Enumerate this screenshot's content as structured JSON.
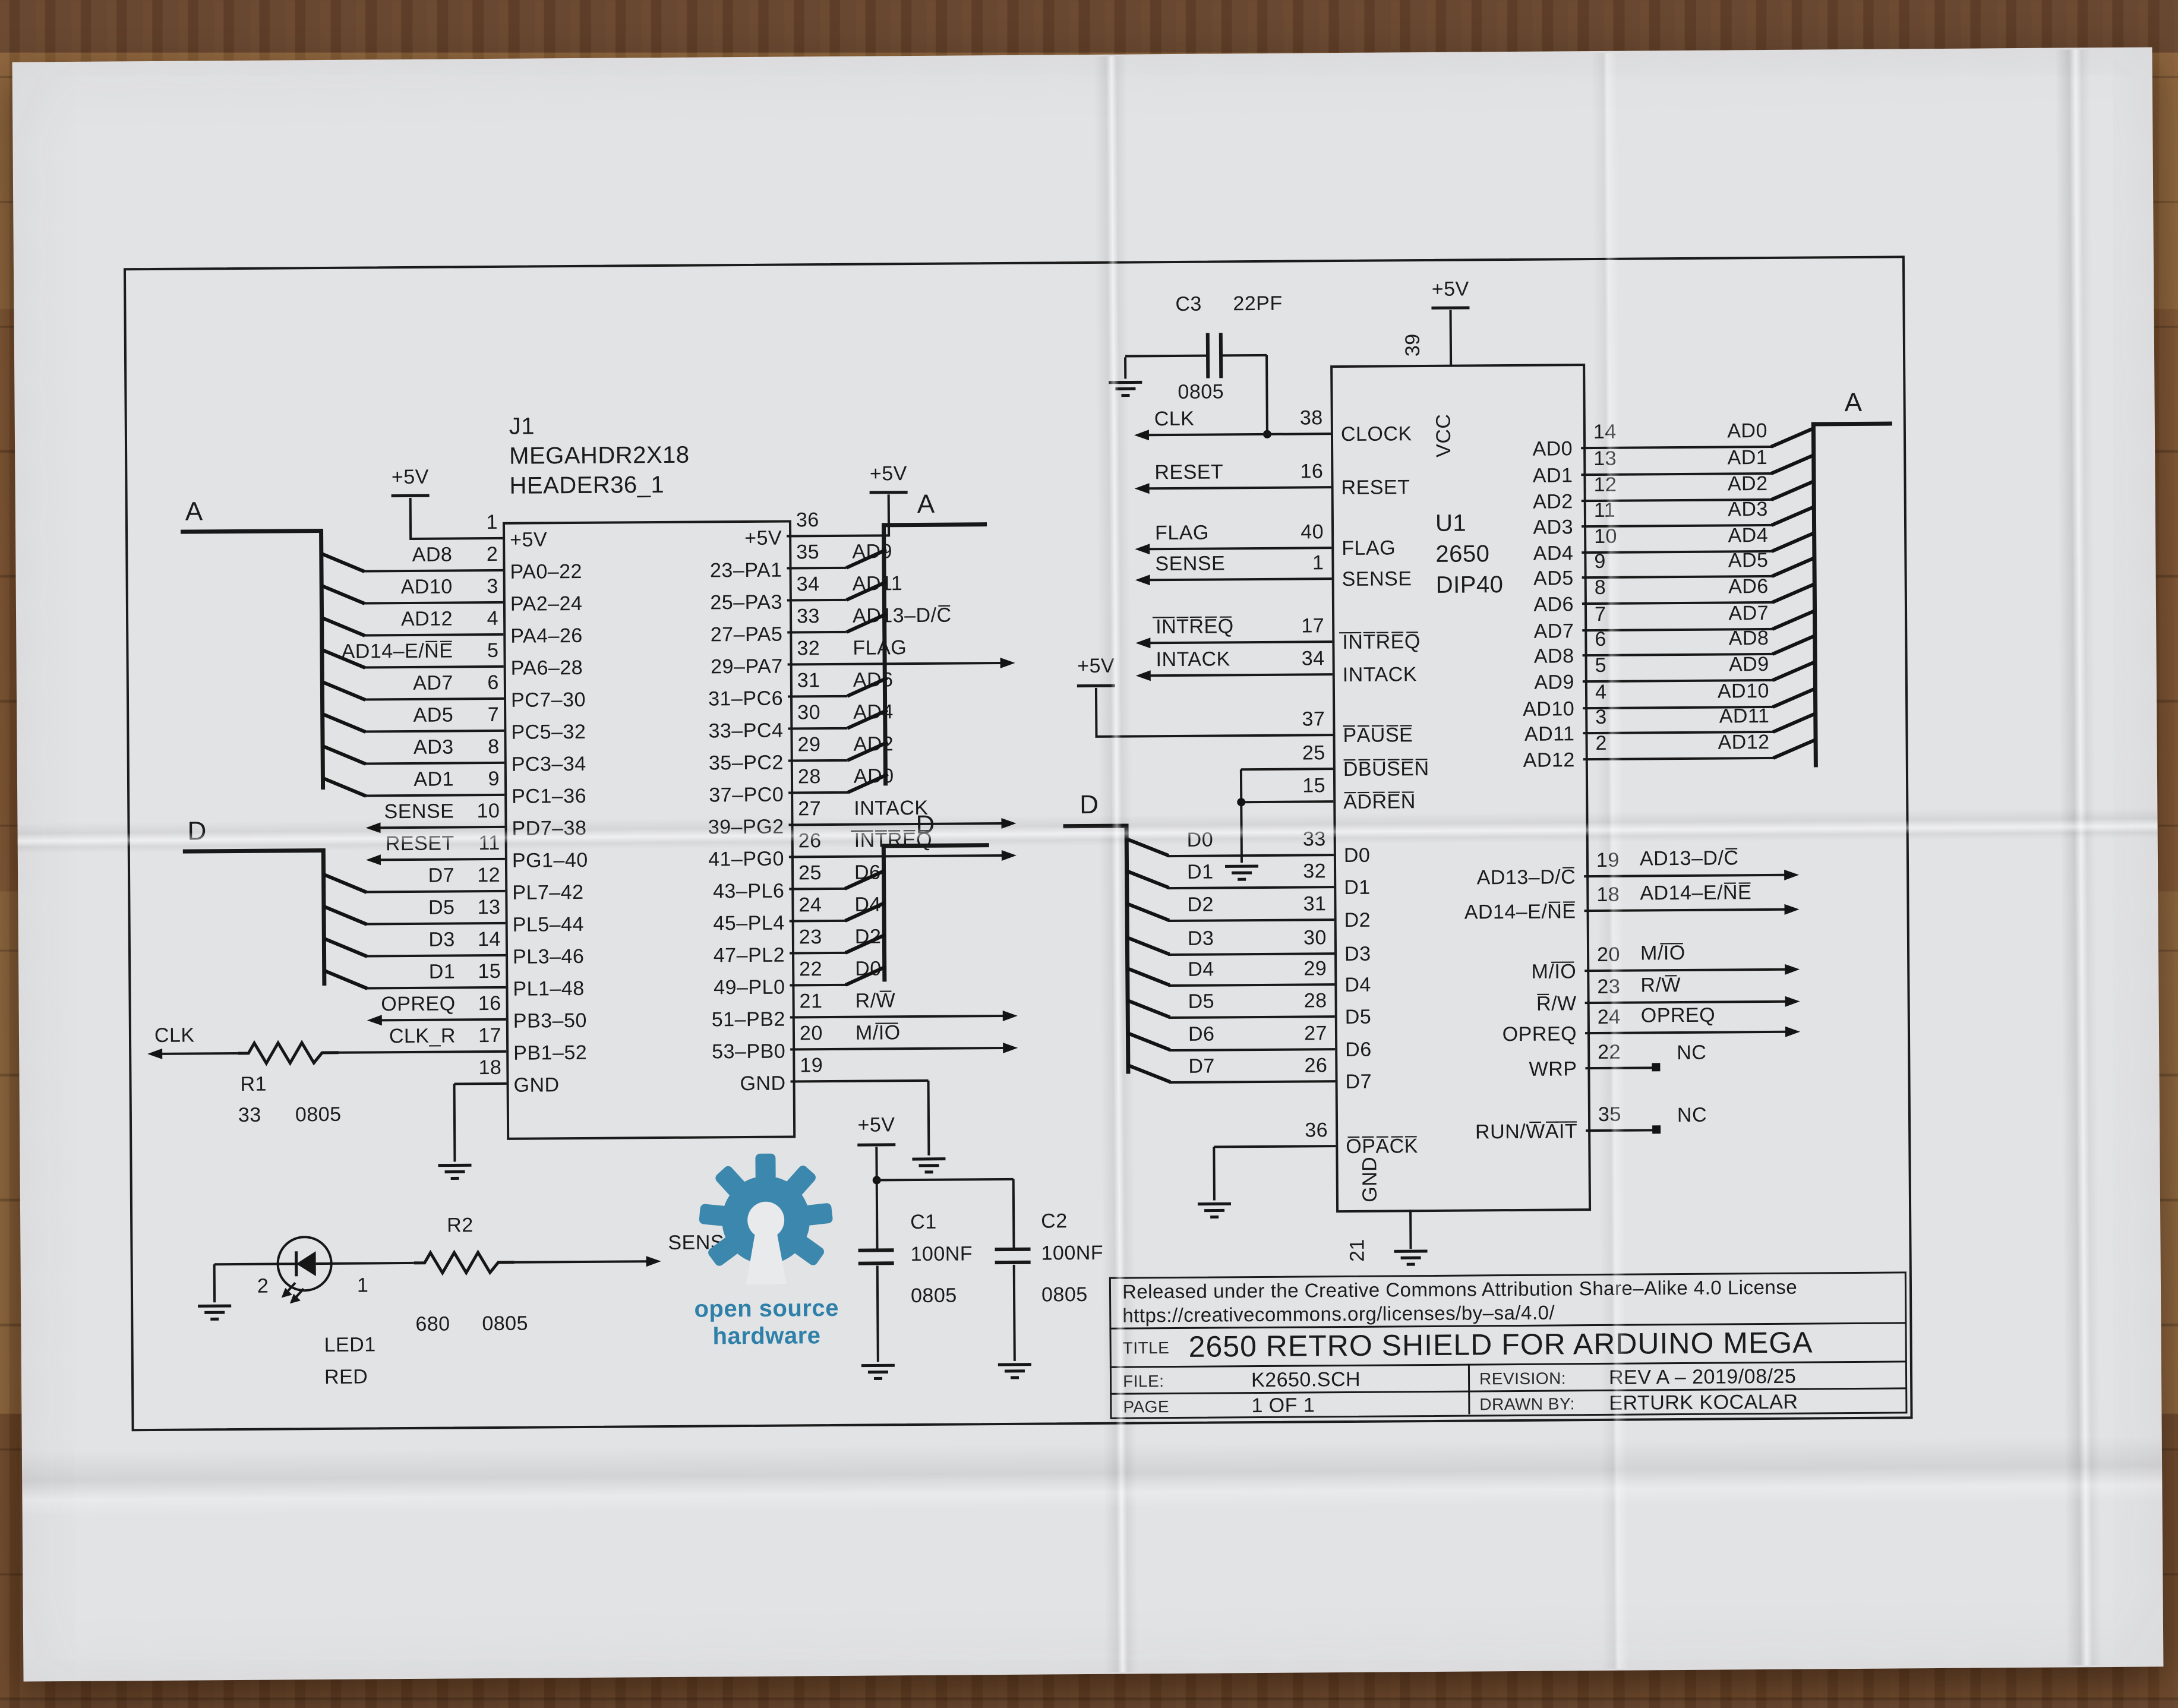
{
  "power": {
    "plus5v": "+5V"
  },
  "buses": {
    "a": "A",
    "d": "D"
  },
  "j1": {
    "ref": "J1",
    "value": "MEGAHDR2X18",
    "footprint": "HEADER36_1",
    "rows": [
      {
        "lext": "",
        "lnum": "1",
        "lint": "+5V",
        "rint": "+5V",
        "rnum": "36",
        "rext": "+5V",
        "lt": "v5",
        "rt": "v5"
      },
      {
        "lext": "AD8",
        "lnum": "2",
        "lint": "PA0–22",
        "rint": "23–PA1",
        "rnum": "35",
        "rext": "AD9",
        "lt": "busA",
        "rt": "busA"
      },
      {
        "lext": "AD10",
        "lnum": "3",
        "lint": "PA2–24",
        "rint": "25–PA3",
        "rnum": "34",
        "rext": "AD11",
        "lt": "busA",
        "rt": "busA"
      },
      {
        "lext": "AD12",
        "lnum": "4",
        "lint": "PA4–26",
        "rint": "27–PA5",
        "rnum": "33",
        "rext": "AD13–D/C̅",
        "lt": "busA",
        "rt": "busA"
      },
      {
        "lext": "AD14–E/N̅E̅",
        "lnum": "5",
        "lint": "PA6–28",
        "rint": "29–PA7",
        "rnum": "32",
        "rext": "FLAG",
        "lt": "busA",
        "rt": "arrow"
      },
      {
        "lext": "AD7",
        "lnum": "6",
        "lint": "PC7–30",
        "rint": "31–PC6",
        "rnum": "31",
        "rext": "AD6",
        "lt": "busA",
        "rt": "busA"
      },
      {
        "lext": "AD5",
        "lnum": "7",
        "lint": "PC5–32",
        "rint": "33–PC4",
        "rnum": "30",
        "rext": "AD4",
        "lt": "busA",
        "rt": "busA"
      },
      {
        "lext": "AD3",
        "lnum": "8",
        "lint": "PC3–34",
        "rint": "35–PC2",
        "rnum": "29",
        "rext": "AD2",
        "lt": "busA",
        "rt": "busA"
      },
      {
        "lext": "AD1",
        "lnum": "9",
        "lint": "PC1–36",
        "rint": "37–PC0",
        "rnum": "28",
        "rext": "AD0",
        "lt": "busA",
        "rt": "busA"
      },
      {
        "lext": "SENSE",
        "lnum": "10",
        "lint": "PD7–38",
        "rint": "39–PG2",
        "rnum": "27",
        "rext": "INTACK",
        "lt": "arrow",
        "rt": "arrow"
      },
      {
        "lext": "RESET",
        "lnum": "11",
        "lint": "PG1–40",
        "rint": "41–PG0",
        "rnum": "26",
        "rext": "I̅N̅T̅R̅E̅Q̅",
        "lt": "arrow",
        "rt": "arrow"
      },
      {
        "lext": "D7",
        "lnum": "12",
        "lint": "PL7–42",
        "rint": "43–PL6",
        "rnum": "25",
        "rext": "D6",
        "lt": "busD",
        "rt": "busD"
      },
      {
        "lext": "D5",
        "lnum": "13",
        "lint": "PL5–44",
        "rint": "45–PL4",
        "rnum": "24",
        "rext": "D4",
        "lt": "busD",
        "rt": "busD"
      },
      {
        "lext": "D3",
        "lnum": "14",
        "lint": "PL3–46",
        "rint": "47–PL2",
        "rnum": "23",
        "rext": "D2",
        "lt": "busD",
        "rt": "busD"
      },
      {
        "lext": "D1",
        "lnum": "15",
        "lint": "PL1–48",
        "rint": "49–PL0",
        "rnum": "22",
        "rext": "D0",
        "lt": "busD",
        "rt": "busD"
      },
      {
        "lext": "OPREQ",
        "lnum": "16",
        "lint": "PB3–50",
        "rint": "51–PB2",
        "rnum": "21",
        "rext": "R/W̅",
        "lt": "arrow",
        "rt": "arrow"
      },
      {
        "lext": "CLK_R",
        "lnum": "17",
        "lint": "PB1–52",
        "rint": "53–PB0",
        "rnum": "20",
        "rext": "M/I̅O̅",
        "lt": "plain",
        "rt": "arrow"
      },
      {
        "lext": "",
        "lnum": "18",
        "lint": "GND",
        "rint": "GND",
        "rnum": "19",
        "rext": "",
        "lt": "gnd",
        "rt": "gnd"
      }
    ]
  },
  "u1": {
    "ref": "U1",
    "value": "2650",
    "package": "DIP40",
    "vcc": {
      "name": "VCC",
      "num": "39"
    },
    "gnd": {
      "name": "GND",
      "num": "21"
    },
    "left_pins": [
      {
        "ext": "CLK",
        "num": "38",
        "int": "CLOCK",
        "t": "arrow"
      },
      {
        "ext": "RESET",
        "num": "16",
        "int": "RESET",
        "t": "arrow"
      },
      {
        "ext": "FLAG",
        "num": "40",
        "int": "FLAG",
        "t": "arrow"
      },
      {
        "ext": "SENSE",
        "num": "1",
        "int": "SENSE",
        "t": "arrow"
      },
      {
        "ext": "I̅N̅T̅R̅E̅Q̅",
        "num": "17",
        "int": "I̅N̅T̅R̅E̅Q̅",
        "t": "arrow"
      },
      {
        "ext": "INTACK",
        "num": "34",
        "int": "INTACK",
        "t": "arrow"
      },
      {
        "ext": "",
        "num": "37",
        "int": "P̅A̅U̅S̅E̅",
        "t": "none"
      },
      {
        "ext": "",
        "num": "25",
        "int": "D̅B̅U̅S̅E̅N̅",
        "t": "none"
      },
      {
        "ext": "",
        "num": "15",
        "int": "A̅D̅R̅E̅N̅",
        "t": "none"
      },
      {
        "ext": "D0",
        "num": "33",
        "int": "D0",
        "t": "busD"
      },
      {
        "ext": "D1",
        "num": "32",
        "int": "D1",
        "t": "busD"
      },
      {
        "ext": "D2",
        "num": "31",
        "int": "D2",
        "t": "busD"
      },
      {
        "ext": "D3",
        "num": "30",
        "int": "D3",
        "t": "busD"
      },
      {
        "ext": "D4",
        "num": "29",
        "int": "D4",
        "t": "busD"
      },
      {
        "ext": "D5",
        "num": "28",
        "int": "D5",
        "t": "busD"
      },
      {
        "ext": "D6",
        "num": "27",
        "int": "D6",
        "t": "busD"
      },
      {
        "ext": "D7",
        "num": "26",
        "int": "D7",
        "t": "busD"
      },
      {
        "ext": "",
        "num": "36",
        "int": "O̅P̅A̅C̅K̅",
        "t": "none"
      }
    ],
    "right_pins": [
      {
        "ext": "AD0",
        "num": "14",
        "int": "AD0",
        "t": "busA"
      },
      {
        "ext": "AD1",
        "num": "13",
        "int": "AD1",
        "t": "busA"
      },
      {
        "ext": "AD2",
        "num": "12",
        "int": "AD2",
        "t": "busA"
      },
      {
        "ext": "AD3",
        "num": "11",
        "int": "AD3",
        "t": "busA"
      },
      {
        "ext": "AD4",
        "num": "10",
        "int": "AD4",
        "t": "busA"
      },
      {
        "ext": "AD5",
        "num": "9",
        "int": "AD5",
        "t": "busA"
      },
      {
        "ext": "AD6",
        "num": "8",
        "int": "AD6",
        "t": "busA"
      },
      {
        "ext": "AD7",
        "num": "7",
        "int": "AD7",
        "t": "busA"
      },
      {
        "ext": "AD8",
        "num": "6",
        "int": "AD8",
        "t": "busA"
      },
      {
        "ext": "AD9",
        "num": "5",
        "int": "AD9",
        "t": "busA"
      },
      {
        "ext": "AD10",
        "num": "4",
        "int": "AD10",
        "t": "busA"
      },
      {
        "ext": "AD11",
        "num": "3",
        "int": "AD11",
        "t": "busA"
      },
      {
        "ext": "AD12",
        "num": "2",
        "int": "AD12",
        "t": "busA"
      },
      {
        "ext": "AD13–D/C̅",
        "num": "19",
        "int": "AD13–D/C̅",
        "t": "arrow"
      },
      {
        "ext": "AD14–E/N̅E̅",
        "num": "18",
        "int": "AD14–E/N̅E̅",
        "t": "arrow"
      },
      {
        "ext": "M/I̅O̅",
        "num": "20",
        "int": "M/I̅O̅",
        "t": "arrow"
      },
      {
        "ext": "R/W̅",
        "num": "23",
        "int": "R̅/W",
        "t": "arrow"
      },
      {
        "ext": "OPREQ",
        "num": "24",
        "int": "OPREQ",
        "t": "arrow"
      },
      {
        "ext": "NC",
        "num": "22",
        "int": "WRP",
        "t": "nc"
      },
      {
        "ext": "NC",
        "num": "35",
        "int": "RUN/W̅A̅I̅T̅",
        "t": "nc"
      }
    ]
  },
  "c3": {
    "ref": "C3",
    "value": "22PF",
    "footprint": "0805"
  },
  "r1": {
    "ref": "R1",
    "value": "33",
    "footprint": "0805",
    "net_in": "CLK"
  },
  "r2": {
    "ref": "R2",
    "value": "680",
    "footprint": "0805",
    "net_out": "SENSE"
  },
  "led1": {
    "ref": "LED1",
    "value": "RED",
    "pin1": "1",
    "pin2": "2"
  },
  "c1": {
    "ref": "C1",
    "value": "100NF",
    "footprint": "0805"
  },
  "c2": {
    "ref": "C2",
    "value": "100NF",
    "footprint": "0805"
  },
  "logo": {
    "line1": "open source",
    "line2": "hardware",
    "color": "#2f80a8"
  },
  "title_block": {
    "license1": "Released under the Creative Commons Attribution Share–Alike 4.0 License",
    "license2": "https://creativecommons.org/licenses/by–sa/4.0/",
    "title_label": "TITLE",
    "title": "2650 RETRO SHIELD FOR ARDUINO MEGA",
    "file_label": "FILE:",
    "file": "K2650.SCH",
    "revision_label": "REVISION:",
    "revision": "REV A – 2019/08/25",
    "page_label": "PAGE",
    "page": "1   OF   1",
    "drawn_label": "DRAWN BY:",
    "drawn_by": "ERTURK KOCALAR"
  }
}
